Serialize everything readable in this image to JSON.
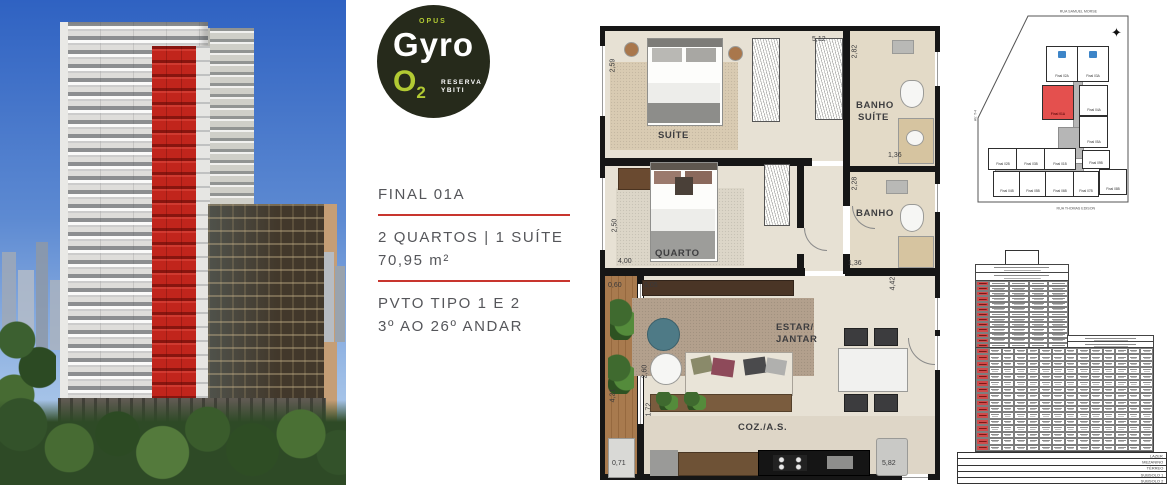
{
  "logo": {
    "opus": "OPUS",
    "name": "Gyro",
    "o2_main": "O",
    "o2_sub": "2",
    "tagline_line1": "RESERVA",
    "tagline_line2": "YBITI"
  },
  "info_panel": {
    "final_label": "FINAL 01A",
    "rooms_line": "2 QUARTOS | 1 SUÍTE",
    "area_line": "70,95 m²",
    "pavement_line": "PVTO TIPO 1 E 2",
    "floors_line": "3º AO 26º ANDAR",
    "accent_color": "#c8352e"
  },
  "floor_plan": {
    "labels": {
      "suite": "SUÍTE",
      "quarto": "QUARTO",
      "banho_suite_1": "BANHO",
      "banho_suite_2": "SUÍTE",
      "banho": "BANHO",
      "estar_1": "ESTAR/",
      "estar_2": "JANTAR",
      "coz": "COZ./A.S."
    },
    "dimensions": {
      "suite_width": "2,59",
      "closet_top": "5,12",
      "banho_suite_height": "2,82",
      "banho_suite_width": "1,36",
      "quarto_height": "2,50",
      "quarto_width": "4,00",
      "banho_height": "2,28",
      "banho_width": "1,36",
      "varanda_top": "0,60",
      "estar_top": "6,05",
      "estar_height": "2,60",
      "varanda_height": "4,21",
      "hall_height": "1,72",
      "varanda_bottom": "0,71",
      "sala_right_height": "4,42",
      "coz_width": "5,82"
    }
  },
  "site_plan": {
    "street_top": "RUA SAMUEL MORSE",
    "street_bottom": "RUA THOMAS EDISON",
    "street_left": "AV. T-4",
    "units": {
      "a02": "Final 02A",
      "a03": "Final 03A",
      "a01": "Final 01A",
      "a04": "Final 04A",
      "a05": "Final 05A",
      "b02": "Final 02B",
      "b03": "Final 03B",
      "b01": "Final 01B",
      "b09": "Final 09B",
      "b04": "Final 04B",
      "b05": "Final 05B",
      "b06": "Final 06B",
      "b07": "Final 07B",
      "b08": "Final 08B"
    },
    "highlight_color": "#e4504e"
  },
  "stack_plan": {
    "upper_grid": {
      "rows": 13,
      "cols": 5,
      "highlight_col": 0
    },
    "lower_grid": {
      "rows": 16,
      "cols": 14,
      "highlight_col": 0
    },
    "base_rows": [
      "LAZER",
      "MEZANINO",
      "TÉRREO",
      "SUBSOLO 1",
      "SUBSOLO 2"
    ],
    "highlight_color": "#cf4b4b"
  }
}
